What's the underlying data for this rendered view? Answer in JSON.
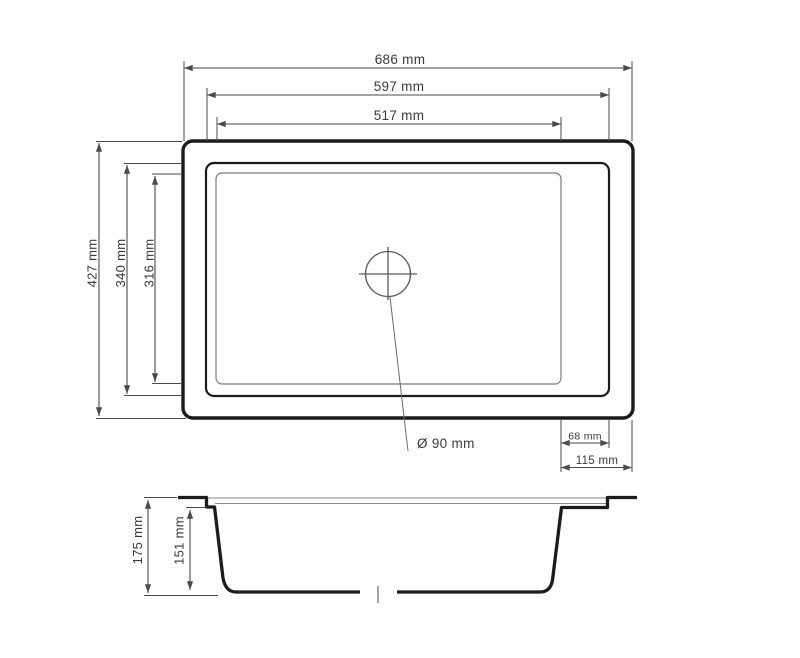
{
  "colors": {
    "dimline": "#4a4a4a",
    "outline": "#1b1b1b",
    "thinline": "#7a7a7a",
    "text": "#3a3a3a",
    "bg": "#ffffff"
  },
  "top_view": {
    "width_dims": [
      {
        "label": "686 mm"
      },
      {
        "label": "597 mm"
      },
      {
        "label": "517 mm"
      }
    ],
    "height_dims": [
      {
        "label": "427 mm"
      },
      {
        "label": "340 mm"
      },
      {
        "label": "316 mm"
      }
    ],
    "drain_label": "Ø 90 mm",
    "edge_dims": [
      {
        "label": "68 mm"
      },
      {
        "label": "115 mm"
      }
    ]
  },
  "section_view": {
    "depth_dims": [
      {
        "label": "175 mm"
      },
      {
        "label": "151 mm"
      }
    ]
  }
}
